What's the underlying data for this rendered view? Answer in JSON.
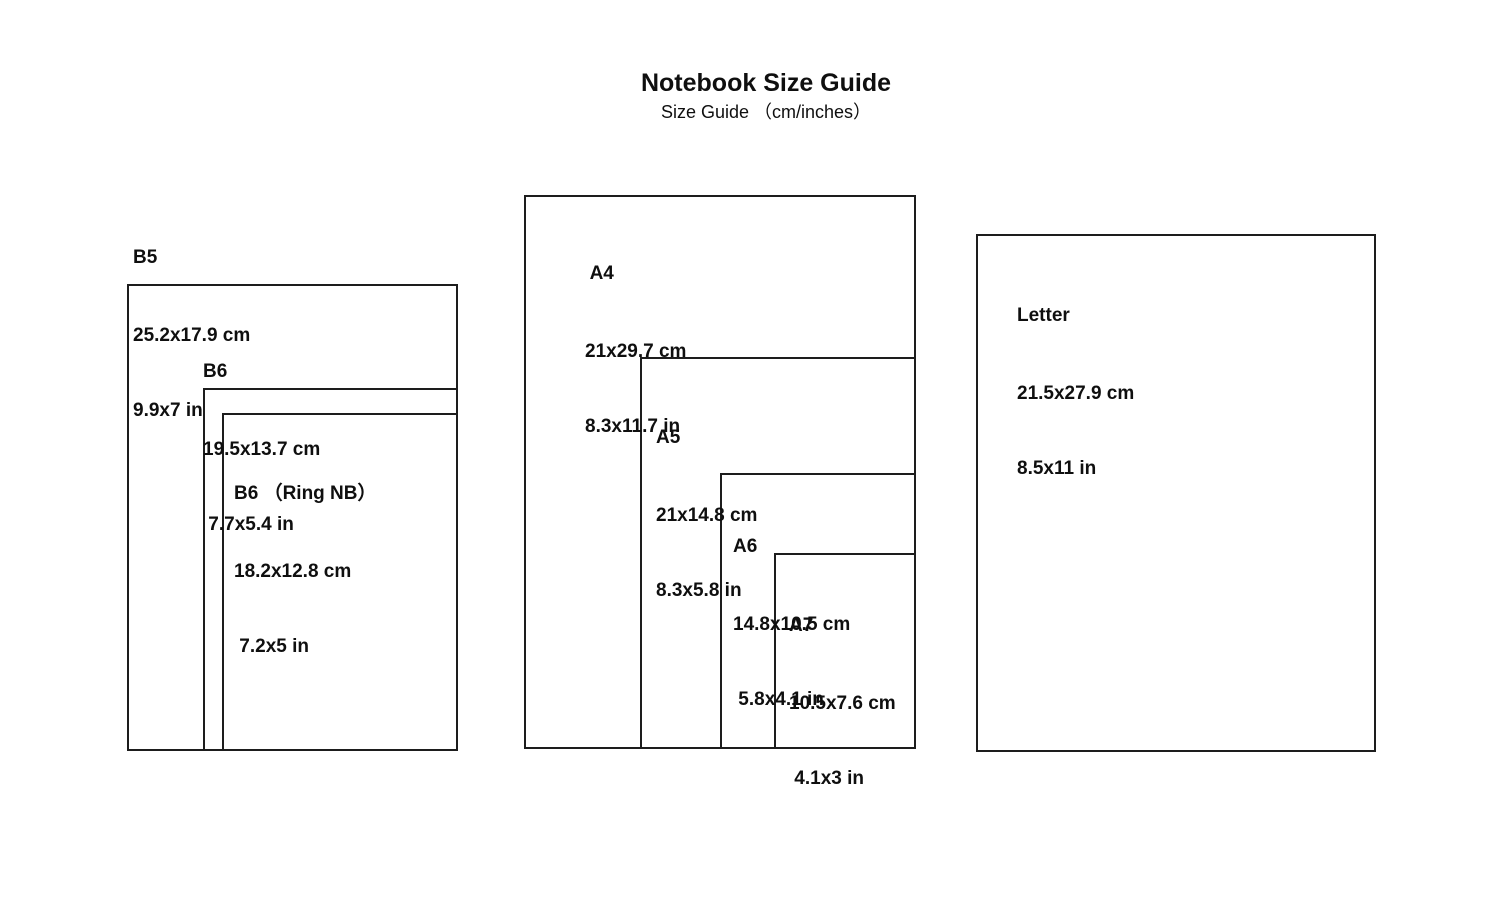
{
  "title": "Notebook Size Guide",
  "subtitle": "Size Guide （cm/inches）",
  "colors": {
    "background": "#ffffff",
    "line": "#1d1d1d",
    "text": "#0f0f0f"
  },
  "sizes": [
    {
      "id": "b5",
      "name": "B5",
      "cm": "25.2x17.9 cm",
      "in": "9.9x7 in"
    },
    {
      "id": "b6",
      "name": "B6",
      "cm": "19.5x13.7 cm",
      "in": " 7.7x5.4 in"
    },
    {
      "id": "b6ring",
      "name": "B6 （Ring NB）",
      "cm": "18.2x12.8 cm",
      "in": " 7.2x5 in"
    },
    {
      "id": "a4",
      "name": " A4",
      "cm": "21x29.7 cm",
      "in": "8.3x11.7 in"
    },
    {
      "id": "a5",
      "name": "A5",
      "cm": "21x14.8 cm",
      "in": "8.3x5.8 in"
    },
    {
      "id": "a6",
      "name": "A6",
      "cm": "14.8x10.5 cm",
      "in": " 5.8x4.1 in"
    },
    {
      "id": "a7",
      "name": "A7",
      "cm": "10.5x7.6 cm",
      "in": " 4.1x3 in"
    },
    {
      "id": "letter",
      "name": "Letter",
      "cm": "21.5x27.9 cm",
      "in": "8.5x11 in"
    }
  ]
}
